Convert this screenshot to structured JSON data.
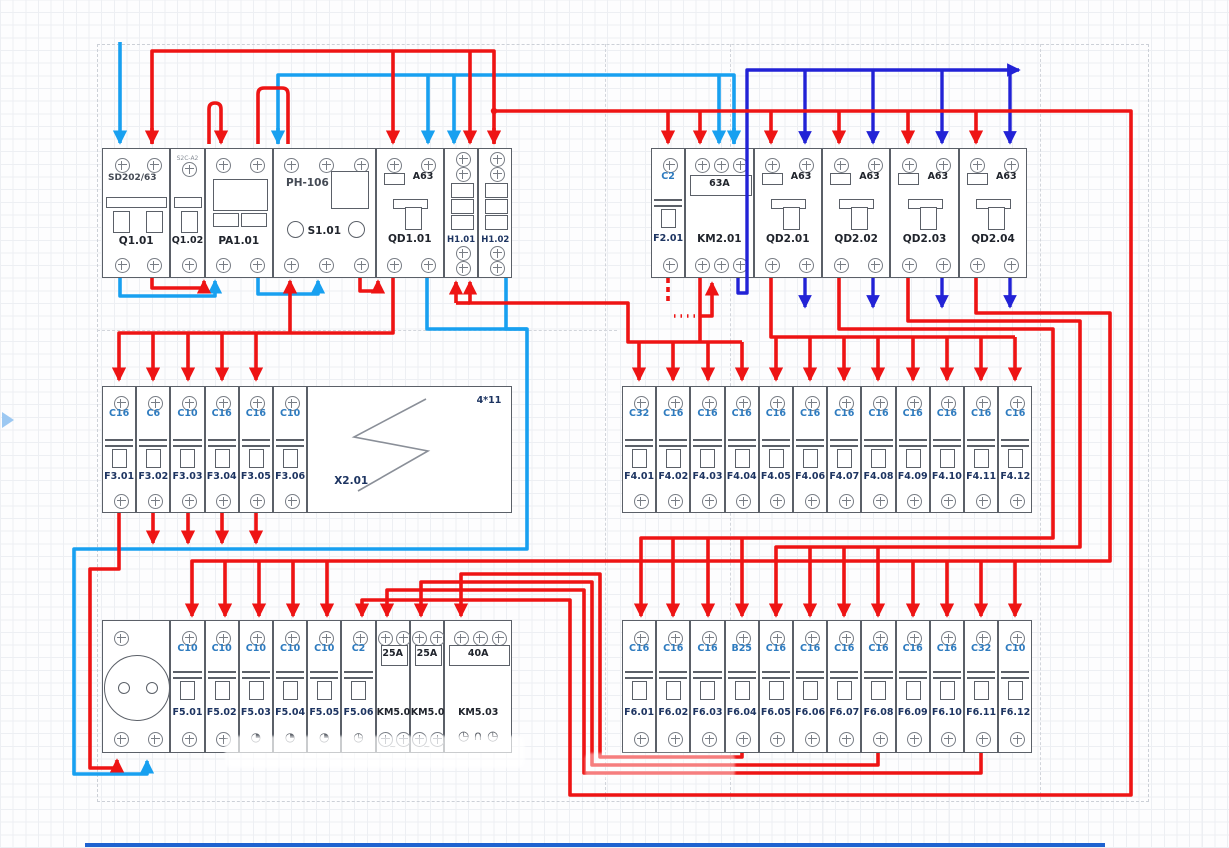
{
  "colors": {
    "phase": "#ee1414",
    "neutral_supply": "#18a0f0",
    "neutral_switched": "#2222d6",
    "module_border": "#5b6068",
    "amp_label": "#2e7bbf",
    "circuit_label": "#1d3461"
  },
  "marks": {
    "play_marker": "left-canvas-arrow"
  },
  "groups": [
    {
      "name": "main-input-row",
      "x0": 102,
      "y": 148,
      "h": 130,
      "modules": [
        {
          "type": "main",
          "span": 2,
          "title": "SD202/63",
          "name": "Q1.01"
        },
        {
          "type": "aux",
          "span": 1,
          "title": "S2C-A2",
          "name": "Q1.02"
        },
        {
          "type": "meter",
          "span": 2,
          "name": "PA1.01"
        },
        {
          "type": "relay",
          "span": 3,
          "title": "РН-106",
          "name": "S1.01"
        },
        {
          "type": "rcd",
          "span": 2,
          "amp": "A63",
          "name": "QD1.01"
        },
        {
          "type": "lamp",
          "span": 1,
          "name": "H1.01"
        },
        {
          "type": "lamp",
          "span": 1,
          "name": "H1.02"
        }
      ]
    },
    {
      "name": "contactor-row",
      "x0": 651,
      "y": 148,
      "h": 130,
      "modules": [
        {
          "type": "mcb",
          "span": 1,
          "amp": "C2",
          "name": "F2.01"
        },
        {
          "type": "contactor",
          "span": 2,
          "amp": "63A",
          "name": "KM2.01",
          "screws": 3
        },
        {
          "type": "rcd",
          "span": 2,
          "amp": "A63",
          "name": "QD2.01"
        },
        {
          "type": "rcd",
          "span": 2,
          "amp": "A63",
          "name": "QD2.02"
        },
        {
          "type": "rcd",
          "span": 2,
          "amp": "A63",
          "name": "QD2.03"
        },
        {
          "type": "rcd",
          "span": 2,
          "amp": "A63",
          "name": "QD2.04"
        }
      ]
    },
    {
      "name": "breaker-row-F3",
      "x0": 102,
      "y": 386,
      "h": 127,
      "modules": [
        {
          "type": "mcb",
          "span": 1,
          "amp": "C16",
          "name": "F3.01"
        },
        {
          "type": "mcb",
          "span": 1,
          "amp": "C6",
          "name": "F3.02"
        },
        {
          "type": "mcb",
          "span": 1,
          "amp": "C10",
          "name": "F3.03"
        },
        {
          "type": "mcb",
          "span": 1,
          "amp": "C16",
          "name": "F3.04"
        },
        {
          "type": "mcb",
          "span": 1,
          "amp": "C16",
          "name": "F3.05"
        },
        {
          "type": "mcb",
          "span": 1,
          "amp": "C10",
          "name": "F3.06"
        },
        {
          "type": "terminal",
          "span": 6,
          "name": "X2.01",
          "extra": "4*11"
        }
      ]
    },
    {
      "name": "breaker-row-F4",
      "x0": 622,
      "y": 386,
      "h": 127,
      "modules": [
        {
          "type": "mcb",
          "span": 1,
          "amp": "C32",
          "name": "F4.01"
        },
        {
          "type": "mcb",
          "span": 1,
          "amp": "C16",
          "name": "F4.02"
        },
        {
          "type": "mcb",
          "span": 1,
          "amp": "C16",
          "name": "F4.03"
        },
        {
          "type": "mcb",
          "span": 1,
          "amp": "C16",
          "name": "F4.04"
        },
        {
          "type": "mcb",
          "span": 1,
          "amp": "C16",
          "name": "F4.05"
        },
        {
          "type": "mcb",
          "span": 1,
          "amp": "C16",
          "name": "F4.06"
        },
        {
          "type": "mcb",
          "span": 1,
          "amp": "C16",
          "name": "F4.07"
        },
        {
          "type": "mcb",
          "span": 1,
          "amp": "C16",
          "name": "F4.08"
        },
        {
          "type": "mcb",
          "span": 1,
          "amp": "C16",
          "name": "F4.09"
        },
        {
          "type": "mcb",
          "span": 1,
          "amp": "C16",
          "name": "F4.10"
        },
        {
          "type": "mcb",
          "span": 1,
          "amp": "C16",
          "name": "F4.11"
        },
        {
          "type": "mcb",
          "span": 1,
          "amp": "C16",
          "name": "F4.12"
        }
      ]
    },
    {
      "name": "breaker-row-F5",
      "x0": 102,
      "y": 620,
      "h": 133,
      "modules": [
        {
          "type": "socket",
          "span": 2,
          "name": "socket-outlet"
        },
        {
          "type": "mcb",
          "span": 1,
          "amp": "C10",
          "name": "F5.01"
        },
        {
          "type": "mcb",
          "span": 1,
          "amp": "C10",
          "name": "F5.02"
        },
        {
          "type": "mcb",
          "span": 1,
          "amp": "C10",
          "name": "F5.03",
          "bottom_glyph": "◔"
        },
        {
          "type": "mcb",
          "span": 1,
          "amp": "C10",
          "name": "F5.04",
          "bottom_glyph": "◔"
        },
        {
          "type": "mcb",
          "span": 1,
          "amp": "C10",
          "name": "F5.05",
          "bottom_glyph": "◔"
        },
        {
          "type": "mcb",
          "span": 1,
          "amp": "C2",
          "name": "F5.06",
          "bottom_glyph": "◷"
        },
        {
          "type": "km5",
          "span": 1,
          "amp": "25A",
          "name": "KM5.01",
          "screws": 2,
          "bottom_note": "~"
        },
        {
          "type": "km5",
          "span": 1,
          "amp": "25A",
          "name": "KM5.02",
          "screws": 2,
          "bottom_note": "~"
        },
        {
          "type": "km5",
          "span": 2,
          "amp": "40A",
          "name": "KM5.03",
          "screws": 3,
          "bottom_glyph": "◷ ∩ ◷"
        }
      ]
    },
    {
      "name": "breaker-row-F6",
      "x0": 622,
      "y": 620,
      "h": 133,
      "modules": [
        {
          "type": "mcb",
          "span": 1,
          "amp": "C16",
          "name": "F6.01"
        },
        {
          "type": "mcb",
          "span": 1,
          "amp": "C16",
          "name": "F6.02"
        },
        {
          "type": "mcb",
          "span": 1,
          "amp": "C16",
          "name": "F6.03"
        },
        {
          "type": "mcb",
          "span": 1,
          "amp": "B25",
          "name": "F6.04"
        },
        {
          "type": "mcb",
          "span": 1,
          "amp": "C16",
          "name": "F6.05"
        },
        {
          "type": "mcb",
          "span": 1,
          "amp": "C16",
          "name": "F6.06"
        },
        {
          "type": "mcb",
          "span": 1,
          "amp": "C16",
          "name": "F6.07"
        },
        {
          "type": "mcb",
          "span": 1,
          "amp": "C16",
          "name": "F6.08"
        },
        {
          "type": "mcb",
          "span": 1,
          "amp": "C16",
          "name": "F6.09"
        },
        {
          "type": "mcb",
          "span": 1,
          "amp": "C16",
          "name": "F6.10"
        },
        {
          "type": "mcb",
          "span": 1,
          "amp": "C32",
          "name": "F6.11"
        },
        {
          "type": "mcb",
          "span": 1,
          "amp": "C10",
          "name": "F6.12"
        }
      ]
    }
  ]
}
